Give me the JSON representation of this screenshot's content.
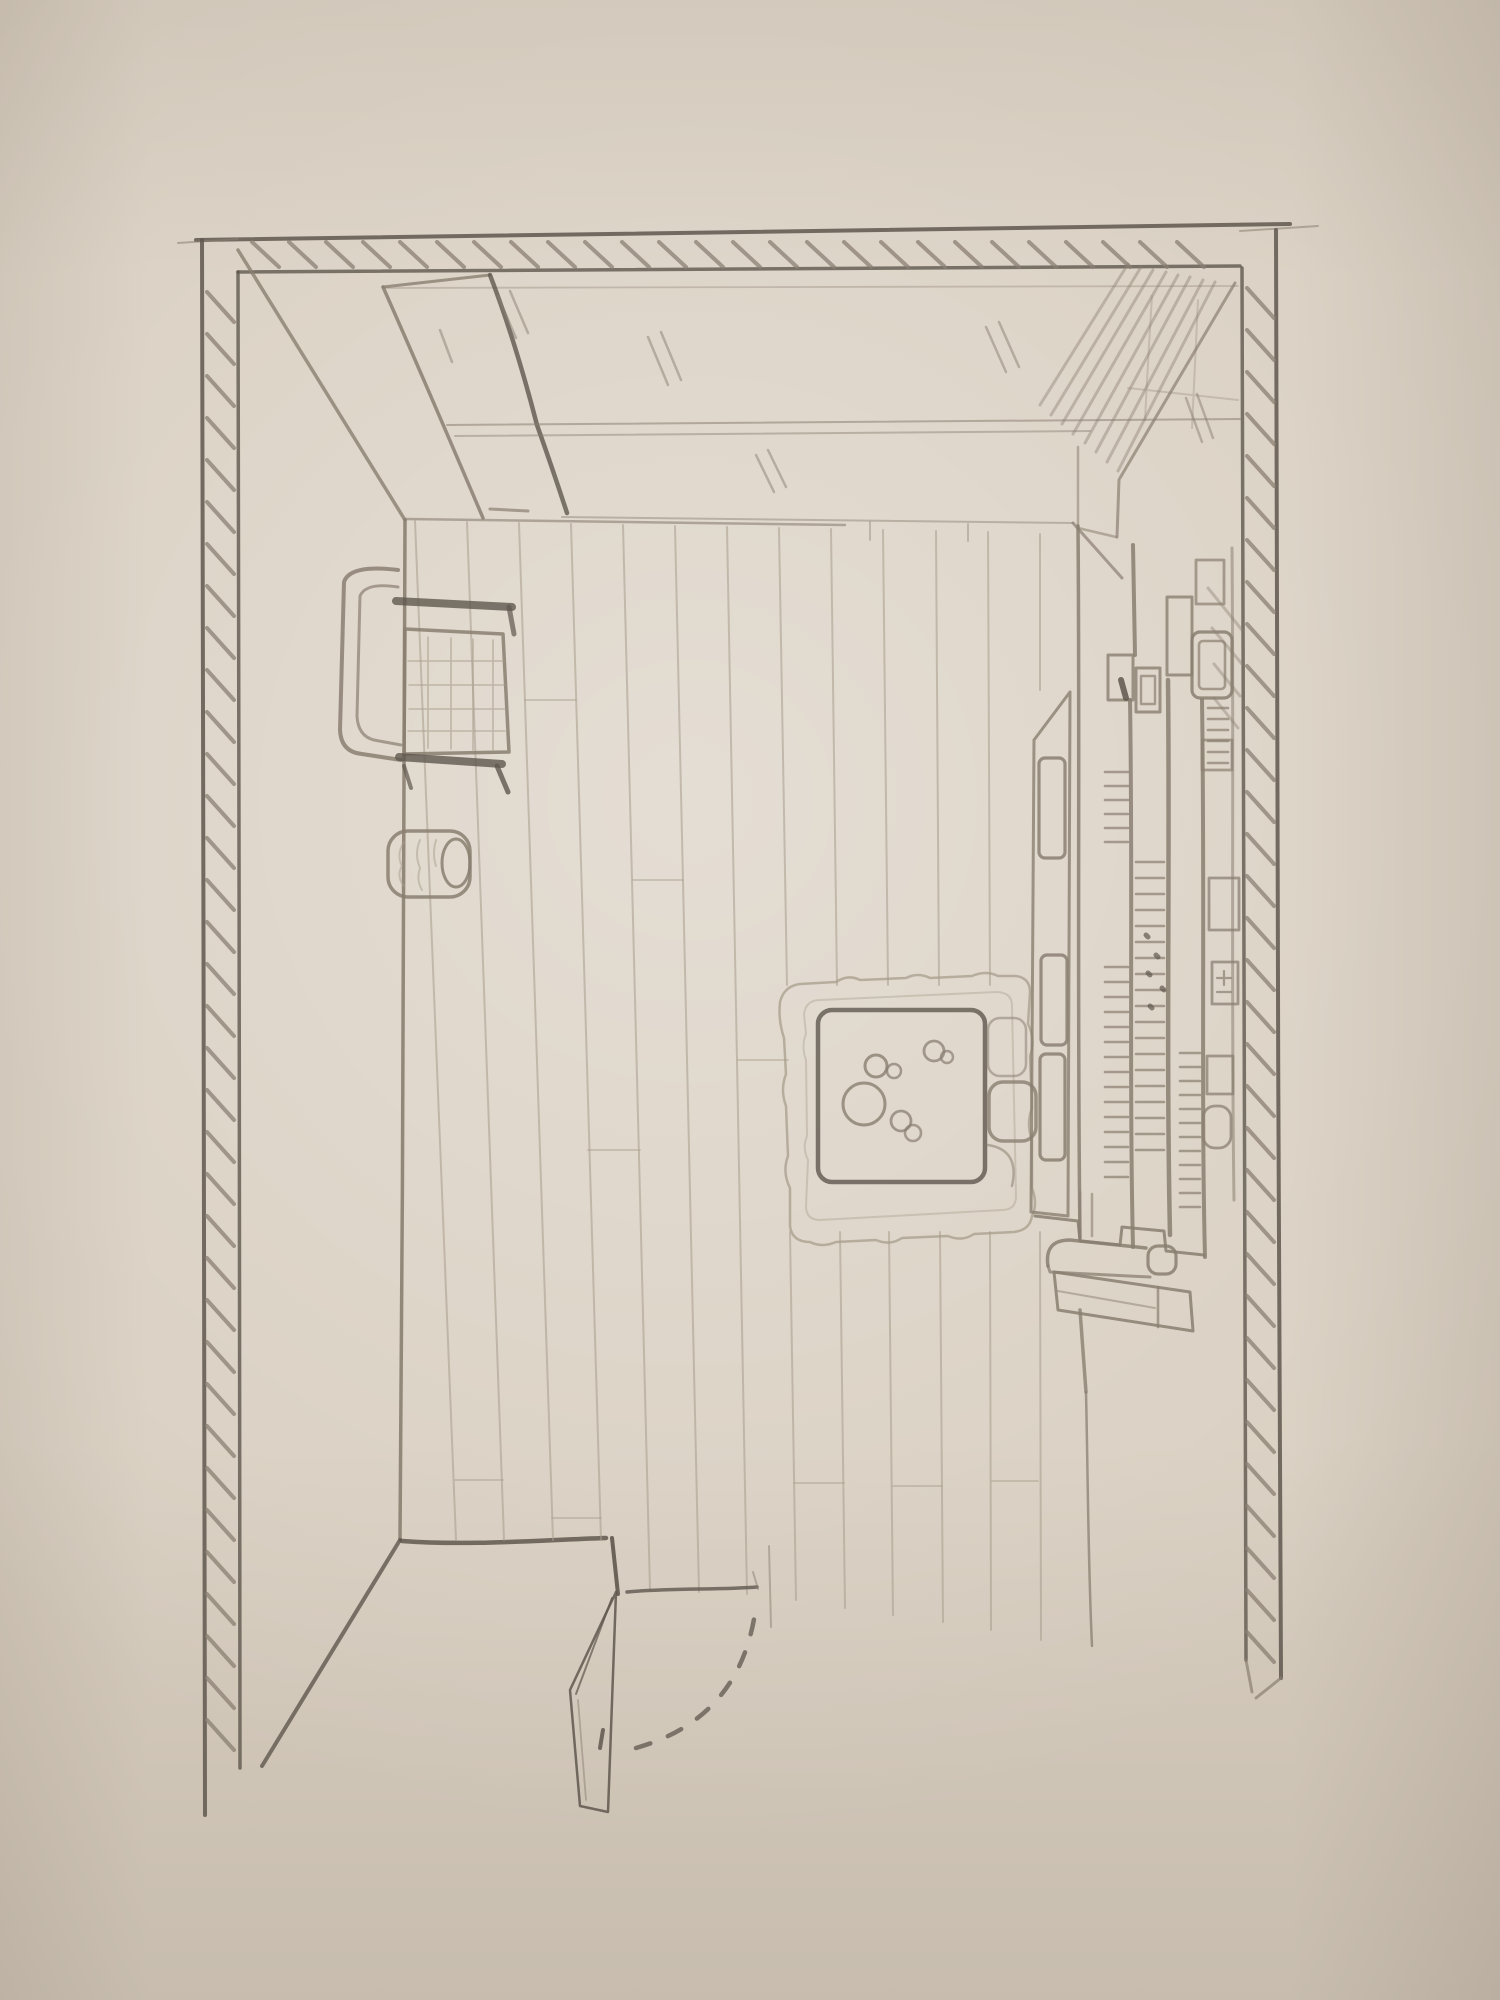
{
  "image": {
    "kind": "pencil sketch on paper",
    "subject": "Top-down perspective sketch of a room interior (bird's-eye floor plan)",
    "width_px": 1500,
    "height_px": 2000
  },
  "colors": {
    "paper": "#d9cfc1",
    "paperLight": "#e7decf",
    "paperEdge": "#c9beae",
    "pencil": "#8a7f71",
    "pencilDark": "#5f574d",
    "pencilLight": "#a89d8c"
  },
  "room": {
    "walls": "three hatched walls: top, left and right, drawn as double-line bars with diagonal hatching; dark corner blocks; left wall has a dark foot block at the bottom",
    "floor": "wooden plank floor, 12 vertical plank lines with staggered end seams",
    "window": "glazed band along the top wall with slanted mullions, sill lines and small reflection slashes",
    "door": "open door at the bottom with a knob and a dashed swing arc"
  },
  "furniture": [
    {
      "name": "desk",
      "desc": "desk with gridded top against the left wall, dark front and back rails"
    },
    {
      "name": "desk-chair",
      "desc": "rounded chair bracket tucked at the left side of the desk"
    },
    {
      "name": "stool",
      "desc": "small round stool below the desk with shaded top and side ellipse"
    },
    {
      "name": "rug",
      "desc": "wavy-edged rectangular area rug in the center-right"
    },
    {
      "name": "table",
      "desc": "square rounded-corner table on the rug"
    },
    {
      "name": "tableware",
      "desc": "plate and small cups drawn as circles on the table"
    },
    {
      "name": "side-chair",
      "desc": "chair tucked on the right edge of the table"
    },
    {
      "name": "wardrobe",
      "desc": "tall wardrobe in the top-right corner, top face shaded with diagonal strokes"
    },
    {
      "name": "glass-cabinet",
      "desc": "narrow cabinet with three glass door panes on the right wall"
    },
    {
      "name": "bookshelf",
      "desc": "shelf unit along the right wall with vertical uprights, rows of book spines and small storage boxes"
    },
    {
      "name": "bench",
      "desc": "low bench/sideboard in front of the bookshelf with one long leg line"
    }
  ],
  "counts": {
    "floor_planks": 12,
    "glass_panes": 3,
    "book_rows": 5
  }
}
